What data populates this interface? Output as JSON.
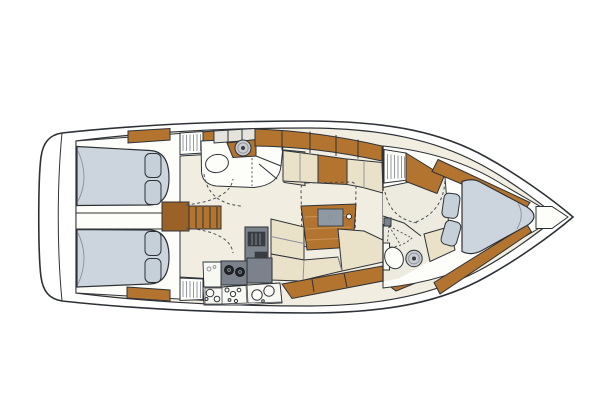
{
  "meta": {
    "title": "Sailing yacht interior layout plan",
    "type": "yacht-floor-plan",
    "view": "top-down",
    "orientation": {
      "bow": "right",
      "stern": "left"
    }
  },
  "areas": {
    "stern": [
      "swim-platform",
      "transom"
    ],
    "aft": [
      "aft-cabin-top",
      "aft-cabin-bottom",
      "companionway-steps",
      "aft-head",
      "hanging-lockers"
    ],
    "midship": [
      "salon",
      "galley",
      "dining-table",
      "settee-top",
      "l-settee-bottom"
    ],
    "forward": [
      "forward-head",
      "shower",
      "hanging-locker",
      "forward-cabin",
      "v-berth",
      "anchor-locker"
    ]
  },
  "fixtures": [
    "double-berth",
    "pillows",
    "toilet",
    "round-washbasin",
    "two-burner-stove",
    "refrigerator",
    "galley-sinks",
    "table-insert",
    "wood-lockers",
    "door-swing-arcs"
  ],
  "colors": {
    "page-bg": "#ffffff",
    "outline": "#2e3237",
    "floor": "#f1eee1",
    "head-floor": "#edebdf",
    "fixture": "#fdfdfa",
    "cabinet": "#e4e4dc",
    "wood": "#b3742f",
    "wood-dark": "#9a6226",
    "grain": "#cb9356",
    "cushion": "#eae1c9",
    "berth": "#ccd5dd",
    "pillow": "#c6d0d9",
    "appliance": "#7b828b",
    "appl-dark": "#383d43",
    "burner": "#212529",
    "sink": "#c9cdd2",
    "insert": "#8e99a4",
    "counter": "#f8f8f3",
    "stripe": "#8a9098",
    "dash": "#4a5056"
  }
}
